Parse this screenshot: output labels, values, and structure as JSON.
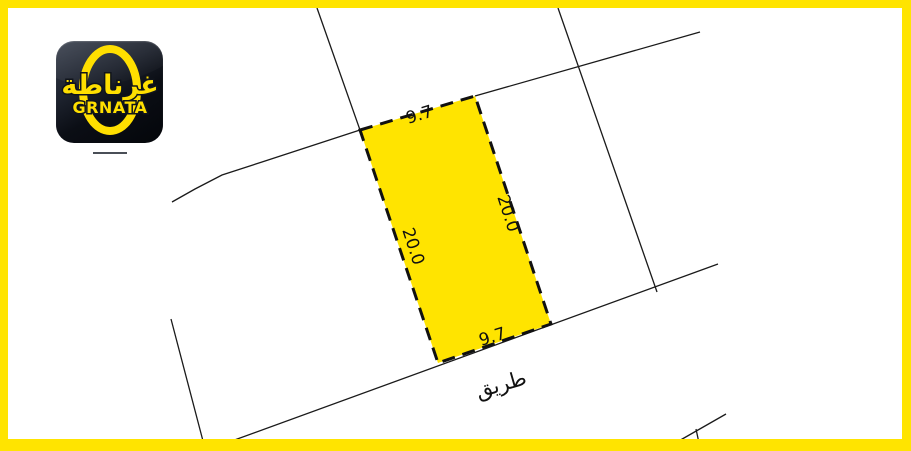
{
  "meta": {
    "frame_color": "#ffe400",
    "paper_color": "#ffffff",
    "line_color": "#1a1a1a",
    "label_color": "#111111"
  },
  "logo": {
    "arabic": "غرناطة",
    "latin": "GRNATA",
    "accent": "#ffdf00",
    "icon_name": "grnata-app-icon"
  },
  "map": {
    "plot": {
      "name": "highlighted-plot",
      "fill": "#ffe400",
      "stroke": "#111111",
      "corners": [
        [
          360,
          130
        ],
        [
          475,
          96
        ],
        [
          551,
          324
        ],
        [
          438,
          363
        ]
      ],
      "dimension_labels": [
        {
          "name": "dim-top",
          "text": "9.7",
          "x": 421,
          "y": 120,
          "rotate": -17,
          "size": 17
        },
        {
          "name": "dim-right",
          "text": "20.0",
          "x": 503,
          "y": 215,
          "rotate": 72,
          "size": 17
        },
        {
          "name": "dim-left",
          "text": "20.0",
          "x": 408,
          "y": 248,
          "rotate": 72,
          "size": 17
        },
        {
          "name": "dim-bottom",
          "text": "9.7",
          "x": 494,
          "y": 342,
          "rotate": -17,
          "size": 17
        }
      ]
    },
    "boundary_lines": [
      {
        "name": "boundary-top-left",
        "d": "M 317 8 L 360 130"
      },
      {
        "name": "boundary-left-curved",
        "d": "M 360 130 L 262 162 L 222 175 L 195 189 L 172 202"
      },
      {
        "name": "boundary-top-right",
        "d": "M 475 96 L 700 32"
      },
      {
        "name": "boundary-vertical-right",
        "d": "M 558 8 L 657 292"
      },
      {
        "name": "road-edge-line",
        "d": "M 229 442 L 718 264"
      },
      {
        "name": "boundary-bottom-left",
        "d": "M 171 319 L 203 441"
      },
      {
        "name": "boundary-bottom-right",
        "d": "M 677 442 L 726 414"
      },
      {
        "name": "boundary-bottom-right-tick",
        "d": "M 696 429 L 699 443"
      }
    ],
    "road_label": {
      "name": "road-label",
      "text": "طريق",
      "x": 503,
      "y": 391,
      "rotate": -16,
      "size": 21
    }
  }
}
